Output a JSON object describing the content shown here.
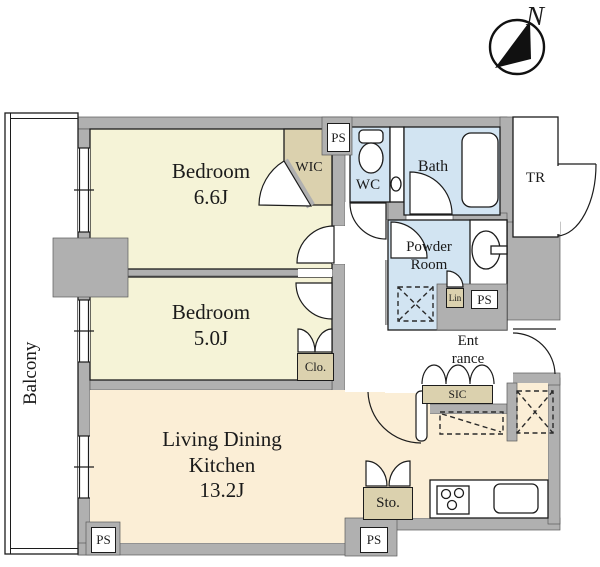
{
  "compass": {
    "north": "N"
  },
  "balcony": {
    "label": "Balcony"
  },
  "rooms": {
    "bedroom1": {
      "name": "Bedroom",
      "area": "6.6J"
    },
    "bedroom2": {
      "name": "Bedroom",
      "area": "5.0J"
    },
    "ldk": {
      "name_line1": "Living Dining",
      "name_line2": "Kitchen",
      "area": "13.2J"
    },
    "wic": {
      "label": "WIC"
    },
    "wc": {
      "label": "WC"
    },
    "bath": {
      "label": "Bath"
    },
    "powder_room": {
      "line1": "Powder",
      "line2": "Room"
    },
    "trunk_room": {
      "label": "TR"
    },
    "entrance": {
      "line1": "Ent",
      "line2": "rance"
    },
    "sic": {
      "label": "SIC"
    },
    "closet": {
      "label": "Clo."
    },
    "linen": {
      "label": "Lin"
    },
    "storage": {
      "label": "Sto."
    },
    "pipe_space": {
      "label": "PS"
    }
  },
  "colors": {
    "wall": "#b0b0b0",
    "bedroom_floor": "#f5f3d7",
    "wet_area_floor": "#d2e4f2",
    "ldk_floor": "#fbeed6",
    "closet_tan": "#dbd1ae"
  }
}
